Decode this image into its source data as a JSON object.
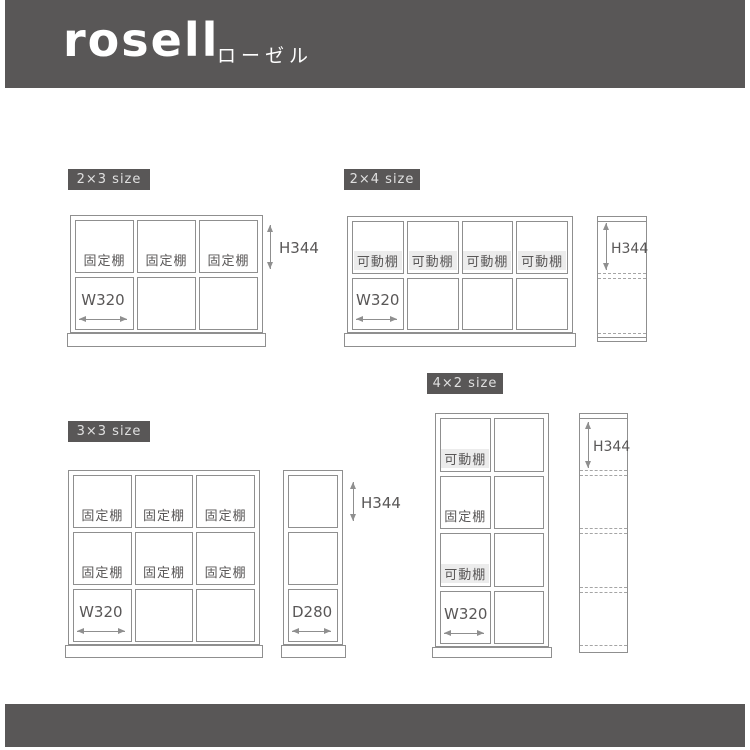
{
  "colors": {
    "banner_bg": "#595757",
    "badge_bg": "#595757",
    "badge_text": "#e0e0e0",
    "line": "#8f8f8f",
    "text": "#595757",
    "movable_label_bg": "#ececec"
  },
  "header": {
    "brand": "rosell",
    "brand_kana": "ローゼル"
  },
  "sections": {
    "s2x3": {
      "badge": "2×3 size",
      "shelf_labels": [
        "固定棚",
        "固定棚",
        "固定棚"
      ],
      "width_dim": "W320",
      "height_dim": "H344"
    },
    "s2x4": {
      "badge": "2×4 size",
      "shelf_labels": [
        "可動棚",
        "可動棚",
        "可動棚",
        "可動棚"
      ],
      "width_dim": "W320",
      "height_dim": "H344"
    },
    "s3x3": {
      "badge": "3×3 size",
      "shelf_labels_row1": [
        "固定棚",
        "固定棚",
        "固定棚"
      ],
      "shelf_labels_row2": [
        "固定棚",
        "固定棚",
        "固定棚"
      ],
      "width_dim": "W320",
      "height_dim": "H344",
      "depth_dim": "D280"
    },
    "s4x2": {
      "badge": "4×2 size",
      "shelf_labels": [
        "可動棚",
        "固定棚",
        "可動棚"
      ],
      "width_dim": "W320",
      "height_dim": "H344"
    }
  }
}
